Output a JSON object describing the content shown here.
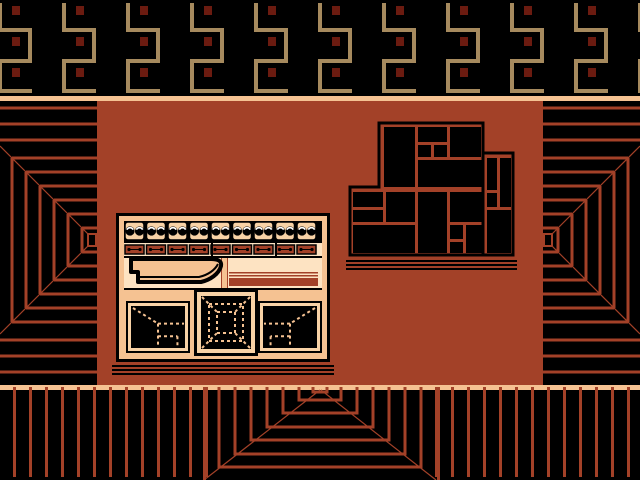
{
  "scene": {
    "title": "temple-control-room",
    "width": 640,
    "height": 480
  },
  "palette": {
    "black": "#000000",
    "rust": "#a34128",
    "dark_red": "#6b1b10",
    "tan": "#a68a5e",
    "peach": "#f5c292",
    "cream": "#fde3c2",
    "module_peach": "#f8d2a6",
    "white": "#ffffff"
  },
  "frieze": {
    "height": 96,
    "unit_width": 64,
    "unit_origin": -2,
    "units": 11,
    "square": {
      "x_offset": 14,
      "w": 8,
      "h": 9,
      "ys": [
        6,
        37,
        68
      ]
    },
    "arm": 34,
    "thick": 4
  },
  "bands": {
    "top_line": [
      0,
      96,
      640,
      5
    ],
    "floor_line": [
      0,
      385,
      640,
      5
    ],
    "wall": [
      97,
      101,
      446,
      284
    ]
  },
  "side_panels": {
    "line_w": 3,
    "top_lines_y": [
      108,
      124,
      140
    ],
    "bottom_lines_y": [
      340,
      356,
      372
    ],
    "bracket_xs_left": [
      12,
      26,
      40,
      54,
      68,
      82
    ],
    "bracket_xs_right": [
      628,
      614,
      600,
      586,
      572,
      558
    ],
    "bracket_tops": [
      158,
      172,
      186,
      200,
      214,
      228
    ],
    "bracket_bottoms": [
      322,
      308,
      294,
      280,
      266,
      252
    ],
    "diag_start_ys": [
      146,
      334
    ],
    "vp_y": 240,
    "vp_rect_left": [
      88,
      234,
      8,
      12
    ],
    "vp_rect_right": [
      544,
      234,
      8,
      12
    ],
    "left_edge": 97,
    "right_edge": 543
  },
  "floor": {
    "top": 390,
    "bottom": 477,
    "line_w": 3,
    "pitch": 16,
    "left_vert_first": 13,
    "left_vert_last": 205,
    "right_vert_first": 627,
    "right_vert_last": 435,
    "outer_verts": [
      203,
      437
    ],
    "u_shapes": [
      [
        219,
        421,
        467
      ],
      [
        235,
        405,
        454
      ],
      [
        251,
        389,
        440
      ],
      [
        267,
        373,
        427
      ],
      [
        283,
        357,
        413
      ],
      [
        299,
        341,
        400
      ],
      [
        313,
        327,
        392
      ]
    ],
    "vp": [
      320,
      390
    ],
    "diag_feet": [
      204,
      436
    ]
  },
  "console": {
    "frame": [
      116,
      213,
      214,
      149
    ],
    "border": 3,
    "inner_pad": 5,
    "knob_row": {
      "y": 221,
      "h": 22,
      "first_x": 125,
      "pitch": 21.5,
      "count": 9,
      "module_w": 19,
      "module_h": 18,
      "knobs_per_module": 2
    },
    "slider_row": {
      "y": 243,
      "h": 13,
      "first_x": 125,
      "pitch": 21.5,
      "count": 9,
      "w": 19,
      "h2": 11,
      "dividers_x": [
        211,
        275
      ]
    },
    "sep_lines_y": [
      256,
      288
    ],
    "mid_band": {
      "y": 258,
      "h": 30,
      "divider_x": 222,
      "divider_w": 6
    },
    "stripes": {
      "x": 229,
      "w": 89,
      "thin_ys": [
        272,
        275
      ],
      "band_y": 278,
      "band_h": 8
    },
    "lever": {
      "x": 126,
      "y": 257,
      "w": 97,
      "h": 30
    },
    "screens": [
      {
        "name": "screen-corner-left",
        "frame": [
          126,
          301,
          64,
          52
        ],
        "art": "corner-left",
        "b1": 2,
        "b2": 3
      },
      {
        "name": "screen-tunnel",
        "frame": [
          194,
          289,
          64,
          67
        ],
        "art": "tunnel",
        "b1": 3,
        "b2": 4
      },
      {
        "name": "screen-corner-right",
        "frame": [
          258,
          301,
          64,
          52
        ],
        "art": "corner-right",
        "b1": 2,
        "b2": 3
      }
    ],
    "base_lines": [
      [
        112,
        365,
        222,
        2
      ],
      [
        112,
        369,
        222,
        2
      ],
      [
        112,
        373,
        222,
        2
      ]
    ]
  },
  "map": {
    "outline": [
      [
        379,
        123
      ],
      [
        483,
        123
      ],
      [
        483,
        153
      ],
      [
        513,
        153
      ],
      [
        513,
        255
      ],
      [
        350,
        255
      ],
      [
        350,
        187
      ],
      [
        379,
        187
      ]
    ],
    "inner_edge": [
      483,
      153,
      483,
      255
    ],
    "rooms": [
      [
        384,
        127,
        31,
        60
      ],
      [
        418,
        127,
        29,
        15
      ],
      [
        450,
        127,
        31,
        30
      ],
      [
        418,
        145,
        13,
        12
      ],
      [
        434,
        145,
        13,
        12
      ],
      [
        418,
        160,
        64,
        27
      ],
      [
        487,
        158,
        10,
        32
      ],
      [
        500,
        158,
        11,
        49
      ],
      [
        487,
        193,
        10,
        14
      ],
      [
        487,
        210,
        24,
        43
      ],
      [
        353,
        192,
        30,
        15
      ],
      [
        353,
        210,
        30,
        12
      ],
      [
        386,
        192,
        29,
        30
      ],
      [
        353,
        225,
        62,
        28
      ],
      [
        418,
        192,
        29,
        61
      ],
      [
        450,
        192,
        32,
        30
      ],
      [
        450,
        225,
        13,
        14
      ],
      [
        450,
        242,
        13,
        11
      ],
      [
        466,
        225,
        16,
        28
      ]
    ],
    "stand_lines": [
      [
        346,
        260,
        171,
        2
      ],
      [
        346,
        264,
        171,
        2
      ],
      [
        346,
        268,
        171,
        2
      ]
    ]
  }
}
